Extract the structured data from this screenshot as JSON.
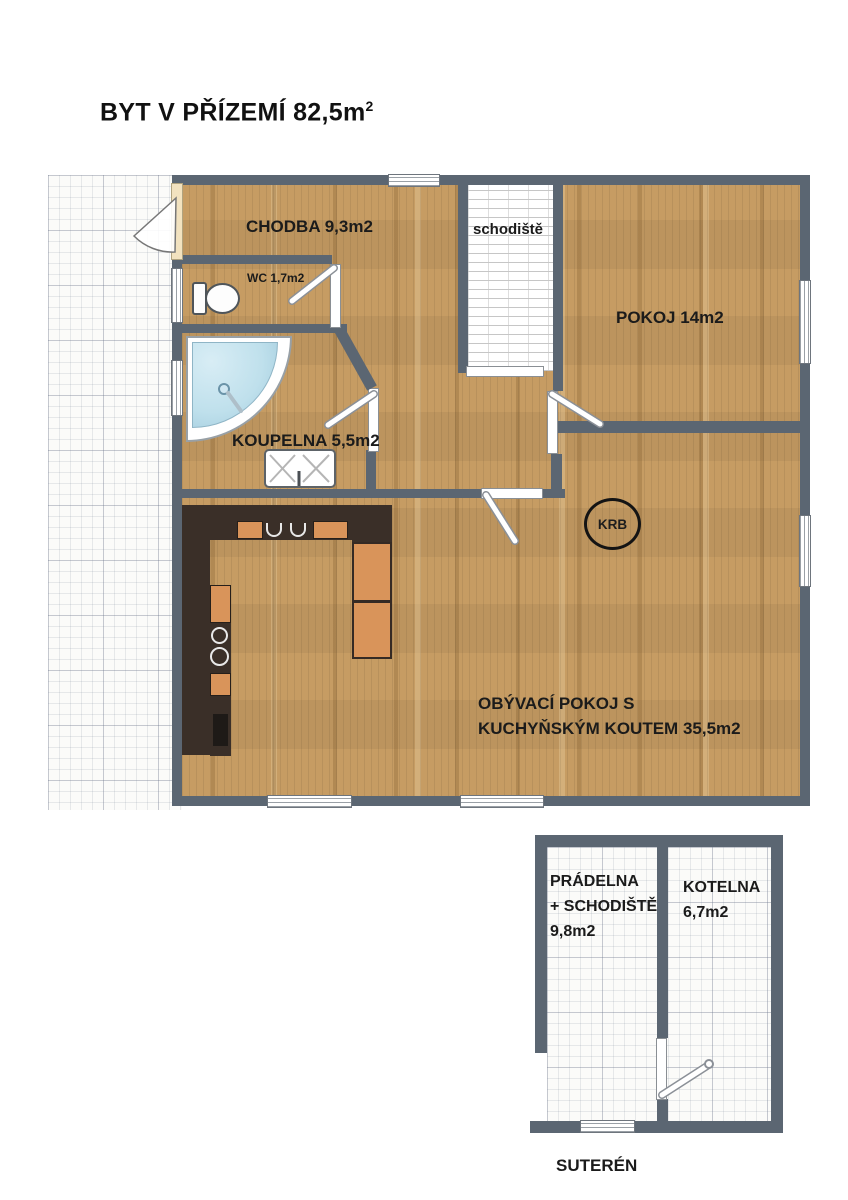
{
  "header": {
    "title_main": "BYT V PŘÍZEMÍ 82,5m",
    "title_sup": "2"
  },
  "ground_floor": {
    "chodba_label": "CHODBA 9,3m2",
    "wc_label": "WC 1,7m2",
    "schodiste_label": "schodiště",
    "pokoj_label": "POKOJ 14m2",
    "koupelna_label": "KOUPELNA 5,5m2",
    "obyvaci_label": "OBÝVACÍ POKOJ S\nKUCHYŇSKÝM KOUTEM 35,5m2",
    "krb_label": "KRB"
  },
  "basement": {
    "pradelna_label": "PRÁDELNA\n+ SCHODIŠTĚ\n9,8m2",
    "kotelna_label": "KOTELNA\n6,7m2",
    "caption": "SUTERÉN"
  },
  "colors": {
    "wall": "#5b6672",
    "floor_wood": "#c69c63",
    "kitchen_counter": "#3a2f28",
    "kitchen_cabinet": "#d9945a",
    "shower_blue": "#bfe0ec",
    "fireplace_outline": "#141414"
  }
}
